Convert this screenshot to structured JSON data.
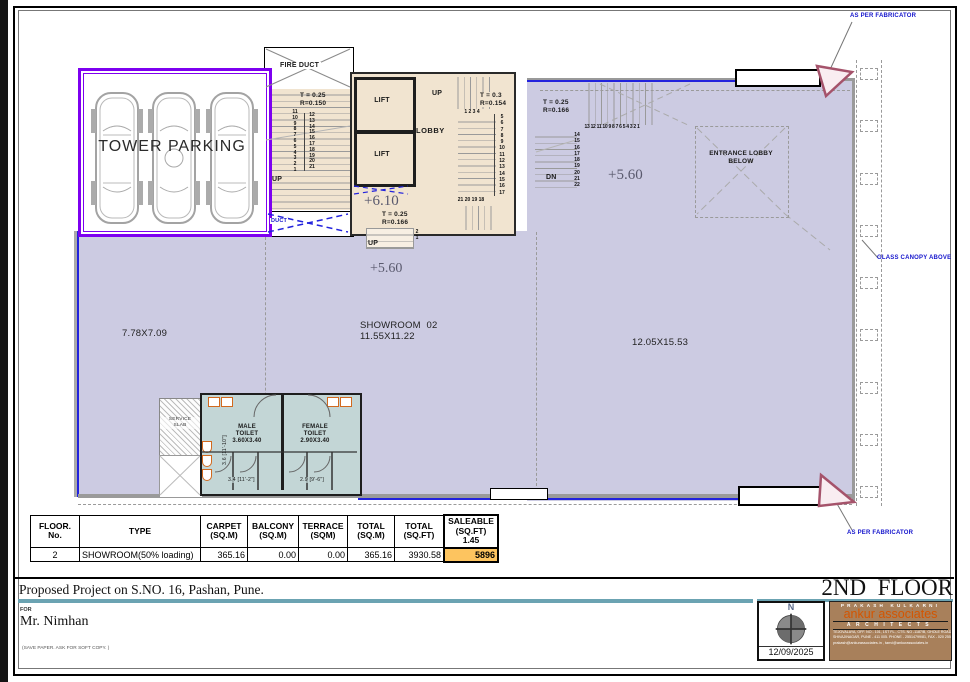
{
  "colors": {
    "parking_border": "#7d00f0",
    "glass_blue": "#2222dd",
    "annotation_blue": "#1414cc",
    "floor_fill": "#cccbe2",
    "core_fill": "#f1e4d0",
    "toilet_fill": "#c3d6d6",
    "highlight_yellow": "#fdc45f",
    "title_teal": "#6ba3b2",
    "architect_brown": "#a8805b",
    "architect_orange": "#d45500",
    "fabricator_pink": "#a5536b"
  },
  "plan": {
    "tower_parking_label": "TOWER PARKING",
    "fire_duct_label": "FIRE DUCT",
    "duct_label": "DUCT",
    "lift1_label": "LIFT",
    "lift2_label": "LIFT",
    "lobby_label": "LOBBY",
    "entrance_lobby_label": "ENTRANCE LOBBY\nBELOW",
    "showroom_label": "SHOWROOM 02\n11.55X11.22",
    "dim_left": "7.78X7.09",
    "dim_right": "12.05X15.53",
    "level_lobby": "+6.10",
    "level_center": "+5.60",
    "level_right": "+5.60",
    "service_slab_label": "SERVICE\nSLAB",
    "male_toilet_label": "MALE\nTOILET\n3.60X3.40",
    "female_toilet_label": "FEMALE\nTOILET\n2.90X3.40",
    "toilet_dim_depth": "3.6 [11'-10\"]",
    "toilet_dim_male": "3.4 [11'-2\"]",
    "toilet_dim_female": "2.9 [9'-6\"]",
    "glass_canopy_note": "GLASS CANOPY ABOVE",
    "fabricator_note_top": "AS PER FABRICATOR",
    "fabricator_note_bottom": "AS PER FABRICATOR",
    "stair_left": {
      "tr": "T = 0.25\nR=0.150",
      "up": "UP",
      "col_a": "11\n10\n9\n8\n7\n6\n5\n4\n3\n2\n1",
      "col_b": "12\n13\n14\n15\n16\n17\n18\n19\n20\n21"
    },
    "stair_lobby": {
      "tr": "T = 0.3\nR=0.154",
      "up": "UP",
      "row_top": "1 2 3 4",
      "col": "5\n6\n7\n8\n9\n10\n11\n12\n13\n14\n15\n16\n17",
      "row_bottom": "21 20 19 18"
    },
    "stair_mid": {
      "tr": "T = 0.25\nR=0.166",
      "up": "UP",
      "col": "2\n1"
    },
    "stair_right": {
      "tr": "T = 0.25\nR=0.166",
      "dn": "DN",
      "row_top": "13 12 11 10 9 8 7 6 5 4 3 2 1",
      "col": "14\n15\n16\n17\n18\n19\n20\n21\n22"
    }
  },
  "table": {
    "headers": [
      "FLOOR.\nNo.",
      "TYPE",
      "CARPET\n(SQ.M)",
      "BALCONY\n(SQ.M)",
      "TERRACE\n(SQM)",
      "TOTAL\n(SQ.M)",
      "TOTAL\n(SQ.FT)",
      "SALEABLE\n(SQ.FT)\n1.45"
    ],
    "row": [
      "2",
      "SHOWROOM(50% loading)",
      "365.16",
      "0.00",
      "0.00",
      "365.16",
      "3930.58",
      "5896"
    ]
  },
  "titleblock": {
    "project_title": "Proposed Project on S.NO. 16, Pashan, Pune.",
    "floor_title": "2ND  FLOOR",
    "for_label": "FOR",
    "client_name": "Mr. Nimhan",
    "paper_note": "(SAVE PAPER. ASK FOR SOFT COPY. )",
    "north_label": "N",
    "date": "12/09/2025",
    "architect_name": "PRAKASH KULKARNI",
    "firm_name": "ankur associates",
    "architects_label": "ARCHITECTS",
    "address_line1": "TEJOVALAYA, OFF. NO - 101, 1ST FL., CTS. NO -1187/B, GHOLE ROAD,",
    "address_line2": "SHIVAJINAGAR, PUNE - 411 005. PHONE - 25514799/81, FAX - 020 25514702",
    "address_line3": "prakash@ankurassociates.in , tanvi@ankurassociates.in"
  }
}
